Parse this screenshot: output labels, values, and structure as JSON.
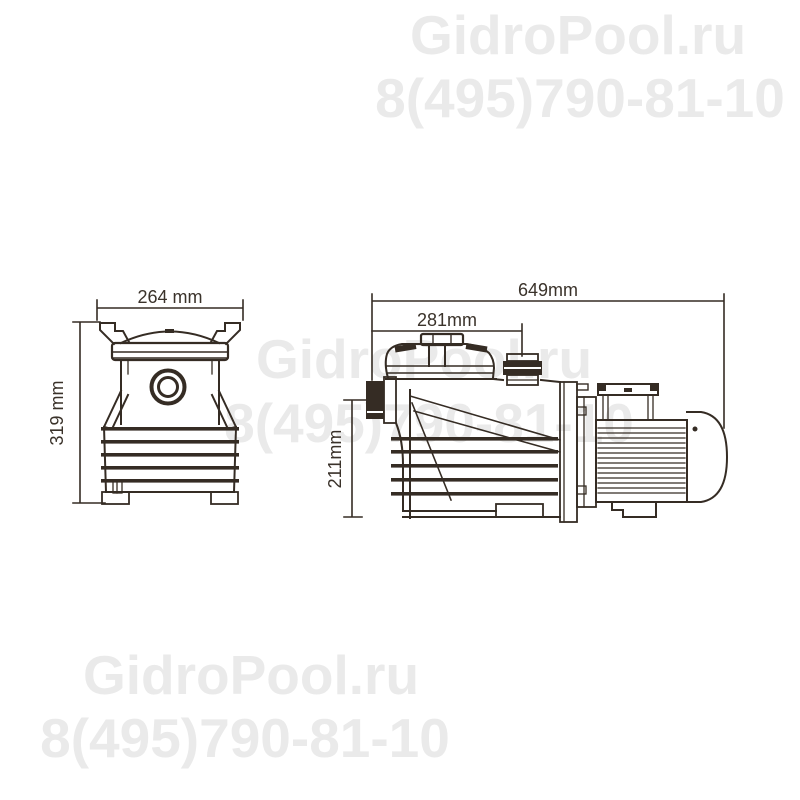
{
  "page": {
    "background": "#ffffff"
  },
  "watermark": {
    "color": "#eaeaea",
    "site": "GidroPool.ru",
    "phone": "8(495)790-81-10"
  },
  "drawing": {
    "line_color": "#352c24",
    "dim_text_color": "#3a322a",
    "front_view": {
      "width_label": "264 mm",
      "height_label": "319 mm"
    },
    "side_view": {
      "length_label": "649mm",
      "lid_offset_label": "281mm",
      "inlet_height_label": "211mm"
    }
  }
}
